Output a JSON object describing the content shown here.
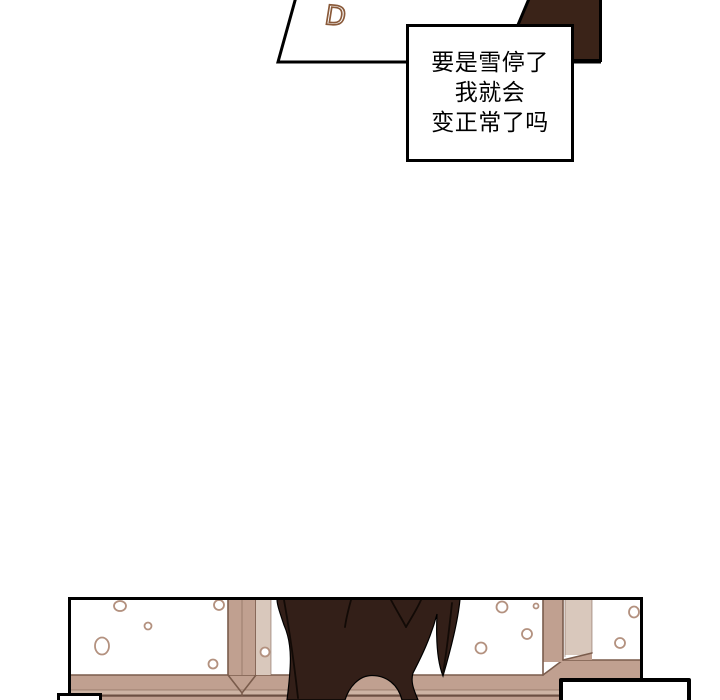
{
  "labels": {
    "panel_letter": "D"
  },
  "speech": {
    "lines": [
      "要是雪停了",
      "我就会",
      "变正常了吗"
    ]
  },
  "colors": {
    "paper": "#ffffff",
    "outline": "#000000",
    "dark_shape": "#3a2318",
    "coat": "#331f18",
    "coat_fold": "#120a06",
    "frame_tan": "#c0a090",
    "frame_light": "#cdb4a4",
    "jamb_light": "#d9c8bc",
    "frame_line": "#7a5c4c",
    "frame_dark": "#6b4f42",
    "snow_ring": "#b3917f",
    "letter_brown": "#8a5a3a"
  }
}
